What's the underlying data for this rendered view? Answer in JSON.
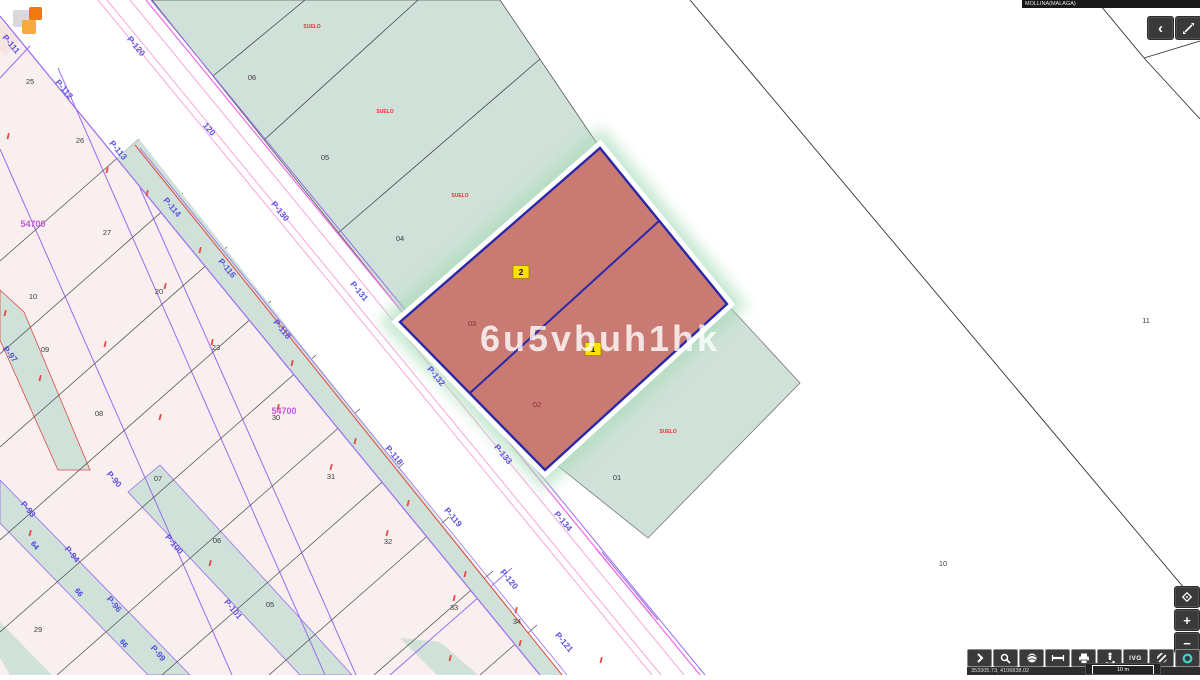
{
  "app": {
    "watermark": "6u5vbuh1hk"
  },
  "header": {
    "municipality": "MOLLINA(MALAGA)",
    "back_glyph": "‹"
  },
  "zoom_controls": {
    "zoom_in_glyph": "+",
    "zoom_out_glyph": "−"
  },
  "toolbar": {
    "ivg_label": "IVG",
    "button_names": [
      "expand-tools",
      "search",
      "basemap-globe",
      "measure-distance",
      "print",
      "street-view",
      "ivg",
      "ortho-stripes",
      "info"
    ]
  },
  "statusbar": {
    "coordinates": "353305.73, 4106838.02",
    "scale_label": "10 m"
  },
  "map": {
    "colors": {
      "parcel_teal": "#cfe1d8",
      "parcel_pink": "#f9efee",
      "parcel_red": "#c97b73",
      "navy_outline": "#2a28a8",
      "purple_line": "#9a6cf0",
      "magenta_line": "#ef6ae0",
      "pink_line": "#f9a6dc",
      "red_line": "#e34a42",
      "marker_yellow": "#ffe100",
      "info_teal": "#3ed3cd"
    },
    "road_labels": [
      {
        "t": "P-111",
        "x": 9,
        "y": 46
      },
      {
        "t": "P-112",
        "x": 62,
        "y": 91
      },
      {
        "t": "P-113",
        "x": 116,
        "y": 152
      },
      {
        "t": "P-114",
        "x": 170,
        "y": 209
      },
      {
        "t": "P-116",
        "x": 225,
        "y": 270
      },
      {
        "t": "P-118",
        "x": 280,
        "y": 331
      },
      {
        "t": "P-118",
        "x": 392,
        "y": 457
      },
      {
        "t": "P-119",
        "x": 451,
        "y": 519
      },
      {
        "t": "P-120",
        "x": 507,
        "y": 581
      },
      {
        "t": "P-121",
        "x": 562,
        "y": 644
      },
      {
        "t": "P-120",
        "x": 134,
        "y": 48
      },
      {
        "t": "120",
        "x": 207,
        "y": 131
      },
      {
        "t": "P-130",
        "x": 278,
        "y": 213
      },
      {
        "t": "P-131",
        "x": 357,
        "y": 293
      },
      {
        "t": "P-132",
        "x": 434,
        "y": 378
      },
      {
        "t": "P-133",
        "x": 501,
        "y": 456
      },
      {
        "t": "P-134",
        "x": 561,
        "y": 523
      },
      {
        "t": "P-90",
        "x": 112,
        "y": 481
      },
      {
        "t": "P-93",
        "x": 26,
        "y": 511
      },
      {
        "t": "P-94",
        "x": 70,
        "y": 556
      },
      {
        "t": "P-96",
        "x": 112,
        "y": 606
      },
      {
        "t": "P-97",
        "x": 8,
        "y": 356
      },
      {
        "t": "P-99",
        "x": 156,
        "y": 655
      },
      {
        "t": "P-100",
        "x": 172,
        "y": 546
      },
      {
        "t": "P-101",
        "x": 231,
        "y": 611
      }
    ],
    "parcel_numbers": [
      {
        "t": "25",
        "x": 30,
        "y": 84
      },
      {
        "t": "26",
        "x": 80,
        "y": 143
      },
      {
        "t": "27",
        "x": 107,
        "y": 235
      },
      {
        "t": "10",
        "x": 33,
        "y": 299
      },
      {
        "t": "20",
        "x": 159,
        "y": 294
      },
      {
        "t": "09",
        "x": 45,
        "y": 352
      },
      {
        "t": "23",
        "x": 216,
        "y": 350
      },
      {
        "t": "08",
        "x": 99,
        "y": 416
      },
      {
        "t": "30",
        "x": 276,
        "y": 420
      },
      {
        "t": "07",
        "x": 158,
        "y": 481
      },
      {
        "t": "06",
        "x": 217,
        "y": 543
      },
      {
        "t": "05",
        "x": 270,
        "y": 607
      },
      {
        "t": "29",
        "x": 38,
        "y": 632
      },
      {
        "t": "31",
        "x": 331,
        "y": 479
      },
      {
        "t": "32",
        "x": 388,
        "y": 544
      },
      {
        "t": "33",
        "x": 454,
        "y": 610
      },
      {
        "t": "34",
        "x": 517,
        "y": 624
      },
      {
        "t": "06",
        "x": 252,
        "y": 80
      },
      {
        "t": "05",
        "x": 325,
        "y": 160
      },
      {
        "t": "04",
        "x": 400,
        "y": 241
      },
      {
        "t": "03",
        "x": 472,
        "y": 326,
        "c": "dark-red"
      },
      {
        "t": "02",
        "x": 537,
        "y": 407,
        "c": "dark-red"
      },
      {
        "t": "01",
        "x": 617,
        "y": 480
      },
      {
        "t": "11",
        "x": 1146,
        "y": 323
      },
      {
        "t": "10",
        "x": 943,
        "y": 566
      }
    ],
    "zone_labels": [
      {
        "t": "54700",
        "x": 33,
        "y": 227
      },
      {
        "t": "54700",
        "x": 284,
        "y": 414
      }
    ],
    "land_use_labels": [
      {
        "t": "SUELO",
        "x": 312,
        "y": 28
      },
      {
        "t": "SUELO",
        "x": 385,
        "y": 113
      },
      {
        "t": "SUELO",
        "x": 460,
        "y": 197
      },
      {
        "t": "SUELO",
        "x": 668,
        "y": 433
      }
    ],
    "house_numbers": [
      {
        "t": "64",
        "x": 33,
        "y": 547
      },
      {
        "t": "66",
        "x": 77,
        "y": 594
      },
      {
        "t": "66",
        "x": 122,
        "y": 645
      }
    ],
    "markers": [
      {
        "t": "2",
        "x": 521,
        "y": 272
      },
      {
        "t": "1",
        "x": 593,
        "y": 349
      }
    ],
    "construction_marks": [
      [
        8,
        133
      ],
      [
        107,
        167
      ],
      [
        147,
        190
      ],
      [
        200,
        247
      ],
      [
        165,
        283
      ],
      [
        105,
        341
      ],
      [
        212,
        339
      ],
      [
        292,
        360
      ],
      [
        278,
        404
      ],
      [
        160,
        414
      ],
      [
        355,
        438
      ],
      [
        331,
        464
      ],
      [
        408,
        500
      ],
      [
        387,
        530
      ],
      [
        465,
        571
      ],
      [
        454,
        595
      ],
      [
        516,
        607
      ],
      [
        520,
        640
      ],
      [
        601,
        657
      ],
      [
        5,
        310
      ],
      [
        40,
        375
      ],
      [
        30,
        530
      ],
      [
        210,
        560
      ],
      [
        450,
        655
      ]
    ]
  }
}
